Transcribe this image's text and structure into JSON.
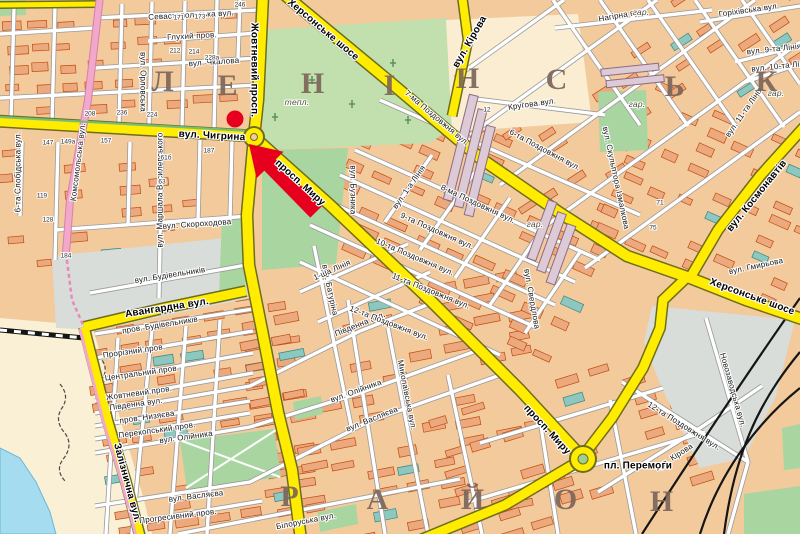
{
  "map": {
    "colors": {
      "land": "#F3CA9C",
      "road_major": "#FFEC00",
      "road_major_casing": "#6D6D1C",
      "street": "#FFFFFF",
      "street_casing": "#9A9A9A",
      "road_pink": "#F2A8C8",
      "green": "#A9D5A0",
      "green_pale": "#C2DFAE",
      "water": "#A5DCF0",
      "sand": "#FAF0D6",
      "gray_area": "#D9DDD9",
      "cream": "#FAEDD2",
      "building": "#ECA97E",
      "building_stroke": "#C14B0E",
      "building_public": "#8CC7C0",
      "marker_red": "#E6001E",
      "rail": "#151515"
    },
    "marker": {
      "type": "dot-with-arrow",
      "color": "#E6001E"
    },
    "district_letters": [
      {
        "ch": "Л",
        "x": 163,
        "y": 82
      },
      {
        "ch": "Е",
        "x": 228,
        "y": 86
      },
      {
        "ch": "Н",
        "x": 313,
        "y": 84
      },
      {
        "ch": "І",
        "x": 390,
        "y": 86
      },
      {
        "ch": "Н",
        "x": 468,
        "y": 79
      },
      {
        "ch": "С",
        "x": 557,
        "y": 80
      },
      {
        "ch": "Ь",
        "x": 675,
        "y": 87
      },
      {
        "ch": "К",
        "x": 767,
        "y": 82
      },
      {
        "ch": "Р",
        "x": 290,
        "y": 497
      },
      {
        "ch": "А",
        "x": 378,
        "y": 500
      },
      {
        "ch": "Й",
        "x": 473,
        "y": 500
      },
      {
        "ch": "О",
        "x": 566,
        "y": 500
      },
      {
        "ch": "Н",
        "x": 662,
        "y": 502
      }
    ],
    "street_labels": [
      {
        "t": "вул. Чигрина",
        "x": 212,
        "y": 136,
        "r": 3,
        "k": "major"
      },
      {
        "t": "Жовтневий просп.",
        "x": 254,
        "y": 70,
        "r": 90,
        "k": "major"
      },
      {
        "t": "просп. Миру",
        "x": 300,
        "y": 183,
        "r": 42,
        "k": "major"
      },
      {
        "t": "просп. Миру",
        "x": 547,
        "y": 430,
        "r": 47,
        "k": "major"
      },
      {
        "t": "Херсонське шосе",
        "x": 323,
        "y": 30,
        "r": 40,
        "k": "major"
      },
      {
        "t": "Херсонське шосе",
        "x": 752,
        "y": 297,
        "r": 20,
        "k": "major"
      },
      {
        "t": "вул. Кірова",
        "x": 470,
        "y": 42,
        "r": -60,
        "k": "major"
      },
      {
        "t": "вул. Космонавтів",
        "x": 757,
        "y": 196,
        "r": -51,
        "k": "major"
      },
      {
        "t": "Авангардна вул.",
        "x": 167,
        "y": 308,
        "r": -9,
        "k": "major"
      },
      {
        "t": "Залізнична вул.",
        "x": 127,
        "y": 483,
        "r": 75,
        "k": "major"
      },
      {
        "t": "Севастопольська вул.",
        "x": 191,
        "y": 15,
        "r": -3,
        "k": "street"
      },
      {
        "t": "Глухий пров.",
        "x": 192,
        "y": 36,
        "r": -3,
        "k": "street"
      },
      {
        "t": "вул. Чкалова",
        "x": 214,
        "y": 62,
        "r": -4,
        "k": "street"
      },
      {
        "t": "вул. Орловська",
        "x": 143,
        "y": 82,
        "r": 90,
        "k": "street"
      },
      {
        "t": "6-та Слобідська вул.",
        "x": 18,
        "y": 172,
        "r": -90,
        "k": "street"
      },
      {
        "t": "вул. Маршала Василевського",
        "x": 160,
        "y": 190,
        "r": -90,
        "k": "street"
      },
      {
        "t": "Комсомольська вул.",
        "x": 78,
        "y": 162,
        "r": -83,
        "k": "street"
      },
      {
        "t": "вул. Скороходова",
        "x": 197,
        "y": 224,
        "r": -4,
        "k": "street"
      },
      {
        "t": "вул. Будівельників",
        "x": 170,
        "y": 275,
        "r": -9,
        "k": "street"
      },
      {
        "t": "пров. Будівельників",
        "x": 160,
        "y": 325,
        "r": -9,
        "k": "street"
      },
      {
        "t": "Прорізний пров.",
        "x": 134,
        "y": 351,
        "r": -8,
        "k": "street"
      },
      {
        "t": "Центральний пров.",
        "x": 142,
        "y": 373,
        "r": -8,
        "k": "street"
      },
      {
        "t": "Жовтневий пров.",
        "x": 139,
        "y": 393,
        "r": -8,
        "k": "street"
      },
      {
        "t": "Південна вул.",
        "x": 136,
        "y": 404,
        "r": -8,
        "k": "street"
      },
      {
        "t": "Південна вул.",
        "x": 360,
        "y": 324,
        "r": -22,
        "k": "street"
      },
      {
        "t": "пров. Низяєва",
        "x": 147,
        "y": 417,
        "r": -8,
        "k": "street"
      },
      {
        "t": "Перекопський пров.",
        "x": 157,
        "y": 430,
        "r": -8,
        "k": "street"
      },
      {
        "t": "вул. Олійника",
        "x": 186,
        "y": 437,
        "r": -8,
        "k": "street"
      },
      {
        "t": "вул. Олійника",
        "x": 356,
        "y": 391,
        "r": -20,
        "k": "street"
      },
      {
        "t": "вул. Васляєва",
        "x": 196,
        "y": 496,
        "r": -7,
        "k": "street"
      },
      {
        "t": "вул. Васляєва",
        "x": 372,
        "y": 419,
        "r": -22,
        "k": "street"
      },
      {
        "t": "Прогресивний пров.",
        "x": 178,
        "y": 516,
        "r": -7,
        "k": "street"
      },
      {
        "t": "Білоруська вул.",
        "x": 306,
        "y": 521,
        "r": -11,
        "k": "street"
      },
      {
        "t": "вул. Батуріна",
        "x": 330,
        "y": 290,
        "r": 78,
        "k": "street"
      },
      {
        "t": "Миколаївська вул.",
        "x": 407,
        "y": 395,
        "r": 79,
        "k": "street"
      },
      {
        "t": "1-ша Лінія",
        "x": 332,
        "y": 270,
        "r": -24,
        "k": "street"
      },
      {
        "t": "вул. Бузника",
        "x": 353,
        "y": 190,
        "r": 90,
        "k": "street"
      },
      {
        "t": "вул. 1-а Лінія",
        "x": 409,
        "y": 187,
        "r": -55,
        "k": "street"
      },
      {
        "t": "Кругова вул.",
        "x": 532,
        "y": 104,
        "r": -8,
        "k": "street"
      },
      {
        "t": "6-та Поздовжня вул.",
        "x": 545,
        "y": 150,
        "r": 28,
        "k": "street"
      },
      {
        "t": "7-ма Поздовжня вул.",
        "x": 437,
        "y": 118,
        "r": 40,
        "k": "street"
      },
      {
        "t": "8-ма Поздовжня вул.",
        "x": 478,
        "y": 204,
        "r": 25,
        "k": "street"
      },
      {
        "t": "9-та Поздовжня вул.",
        "x": 437,
        "y": 231,
        "r": 24,
        "k": "street"
      },
      {
        "t": "10-та Поздовжня вул.",
        "x": 415,
        "y": 257,
        "r": 23,
        "k": "street"
      },
      {
        "t": "11-та Поздовжня вул.",
        "x": 431,
        "y": 291,
        "r": 22,
        "k": "street"
      },
      {
        "t": "12-та Поздовжня вул.",
        "x": 389,
        "y": 323,
        "r": 21,
        "k": "street"
      },
      {
        "t": "12-та Поздовжня вул.",
        "x": 684,
        "y": 426,
        "r": 32,
        "k": "street"
      },
      {
        "t": "вул. Свердлова",
        "x": 532,
        "y": 299,
        "r": 80,
        "k": "street"
      },
      {
        "t": "вул. Скульптора Ізмалкова",
        "x": 616,
        "y": 178,
        "r": 78,
        "k": "street"
      },
      {
        "t": "вул. Гмирьова",
        "x": 756,
        "y": 266,
        "r": -12,
        "k": "street"
      },
      {
        "t": "вул. 11-та Лінія",
        "x": 744,
        "y": 112,
        "r": -55,
        "k": "street"
      },
      {
        "t": "вул. 9-та Лінія",
        "x": 774,
        "y": 49,
        "r": -6,
        "k": "street"
      },
      {
        "t": "вул. 10-та Лінія",
        "x": 781,
        "y": 66,
        "r": -6,
        "k": "street"
      },
      {
        "t": "Горіхівська вул.",
        "x": 749,
        "y": 10,
        "r": -8,
        "k": "street"
      },
      {
        "t": "Нагірна вул.",
        "x": 622,
        "y": 15,
        "r": -10,
        "k": "street"
      },
      {
        "t": "Новозаводська вул.",
        "x": 733,
        "y": 390,
        "r": 74,
        "k": "street"
      },
      {
        "t": "вул. Кірова",
        "x": 674,
        "y": 457,
        "r": -33,
        "k": "street"
      },
      {
        "t": "пл. Перемоги",
        "x": 638,
        "y": 466,
        "r": 0,
        "k": "place"
      },
      {
        "t": "тепл.",
        "x": 297,
        "y": 102,
        "r": 0,
        "k": "area"
      },
      {
        "t": "гар.",
        "x": 637,
        "y": 104,
        "r": 0,
        "k": "area"
      },
      {
        "t": "гар.",
        "x": 535,
        "y": 224,
        "r": 0,
        "k": "area"
      },
      {
        "t": "гар.",
        "x": 641,
        "y": 12,
        "r": 0,
        "k": "area"
      },
      {
        "t": "гар.",
        "x": 776,
        "y": 93,
        "r": 0,
        "k": "area"
      }
    ],
    "house_numbers": [
      {
        "t": "147",
        "x": 48,
        "y": 143
      },
      {
        "t": "149а",
        "x": 68,
        "y": 142
      },
      {
        "t": "157",
        "x": 106,
        "y": 141
      },
      {
        "t": "187",
        "x": 209,
        "y": 151
      },
      {
        "t": "61б",
        "x": 166,
        "y": 158
      },
      {
        "t": "63",
        "x": 162,
        "y": 182
      },
      {
        "t": "119",
        "x": 42,
        "y": 196
      },
      {
        "t": "128",
        "x": 48,
        "y": 220
      },
      {
        "t": "184",
        "x": 66,
        "y": 256
      },
      {
        "t": "171",
        "x": 179,
        "y": 18
      },
      {
        "t": "173",
        "x": 200,
        "y": 17
      },
      {
        "t": "212",
        "x": 175,
        "y": 51
      },
      {
        "t": "214",
        "x": 194,
        "y": 52
      },
      {
        "t": "228а",
        "x": 212,
        "y": 58
      },
      {
        "t": "246",
        "x": 240,
        "y": 5
      },
      {
        "t": "208",
        "x": 90,
        "y": 114
      },
      {
        "t": "236",
        "x": 122,
        "y": 113
      },
      {
        "t": "224",
        "x": 152,
        "y": 115
      },
      {
        "t": "12",
        "x": 487,
        "y": 110
      },
      {
        "t": "71",
        "x": 660,
        "y": 203
      },
      {
        "t": "75",
        "x": 653,
        "y": 228
      }
    ]
  }
}
